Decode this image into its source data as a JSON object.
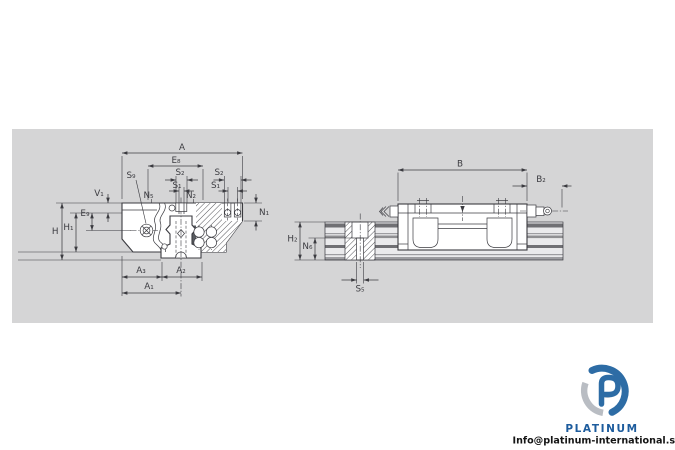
{
  "drawing": {
    "front_view": {
      "dim_labels": {
        "A": "A",
        "E8": "E₈",
        "S2_left": "S₂",
        "S1_left": "S₁",
        "S2_right": "S₂",
        "S1_right": "S₁",
        "S9": "S₉",
        "N5": "N₅",
        "N2": "N₂",
        "N1": "N₁",
        "V1": "V₁",
        "E9": "E₉",
        "H": "H",
        "H1": "H₁",
        "A3": "A₃",
        "A2": "A₂",
        "A1": "A₁"
      }
    },
    "side_view": {
      "dim_labels": {
        "B": "B",
        "B2": "B₂",
        "H2": "H₂",
        "N6": "N₆",
        "S5": "S₅"
      }
    }
  },
  "branding": {
    "logo_text": "PLATINUM",
    "email": "Info@platinum-international.store"
  },
  "colors": {
    "canvas": "#ffffff",
    "panel": "#d5d5d6",
    "line": "#3b3b40",
    "hatch": "#55555a",
    "band-dark": "#707074",
    "band-mid": "#9d9da1",
    "rail-face": "#eaeaec",
    "logo-blue": "#2d6ca5",
    "logo-gray": "#b9bdc3",
    "brand-text": "#1d5c9d",
    "email-text": "#151515"
  }
}
